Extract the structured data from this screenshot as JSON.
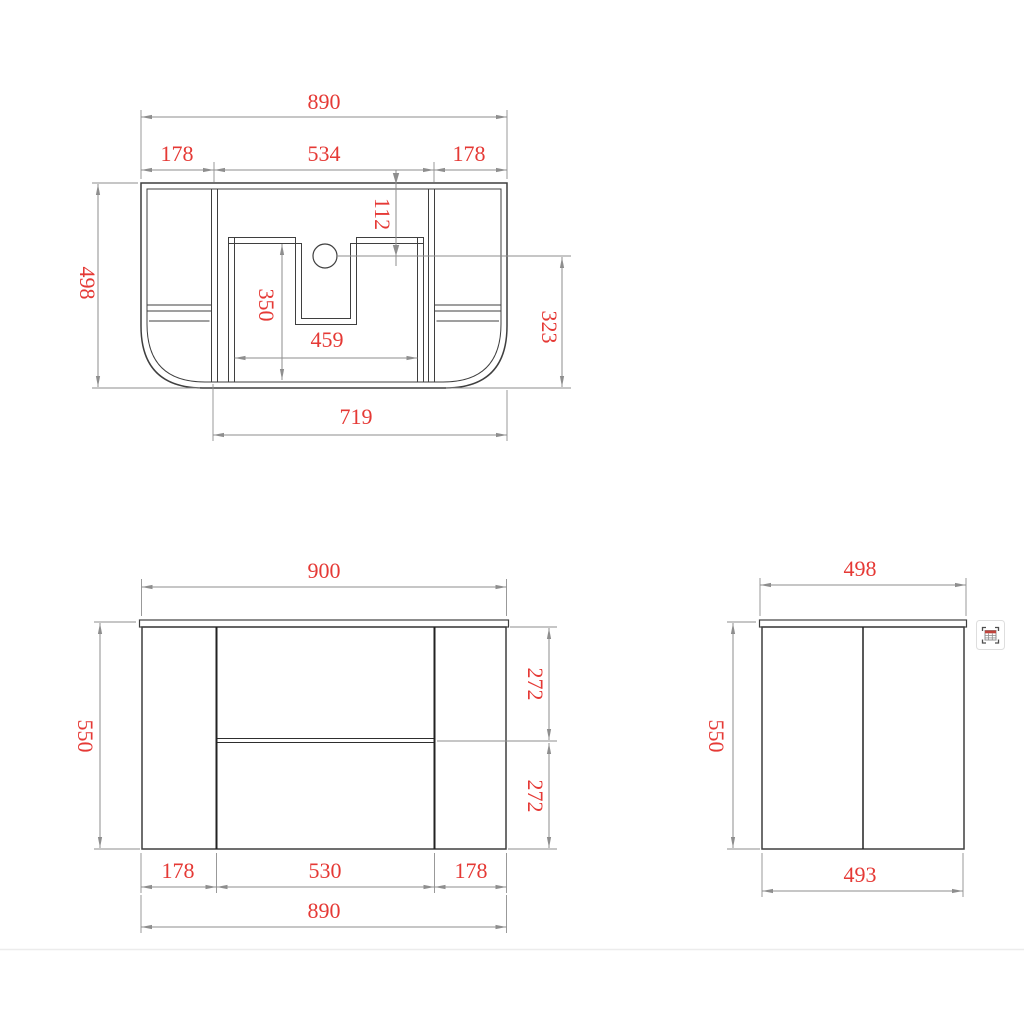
{
  "drawing": {
    "kind": "vanity-cabinet-dimension-drawing",
    "colors": {
      "dimension_text": "#e53935",
      "drawing_line": "#3f3f3f",
      "dimension_line": "#8e8e8e",
      "separator": "#ececec",
      "icon_accent": "#c0443c",
      "background": "#ffffff"
    },
    "top_view": {
      "dims": {
        "overall_width": "890",
        "left_section": "178",
        "middle_section": "534",
        "right_section": "178",
        "hole_offset": "112",
        "overall_depth": "498",
        "cutout_depth": "350",
        "cutout_width": "459",
        "hole_to_front": "323",
        "base_width": "719"
      }
    },
    "front_view": {
      "dims": {
        "top_width": "900",
        "height": "550",
        "upper_section": "272",
        "lower_section": "272",
        "bottom_left": "178",
        "bottom_middle": "530",
        "bottom_right": "178",
        "overall_width": "890"
      }
    },
    "side_view": {
      "dims": {
        "top_depth": "498",
        "height": "550",
        "bottom_depth": "493"
      }
    },
    "tools": {
      "table_extract_icon": "table-extract"
    }
  }
}
